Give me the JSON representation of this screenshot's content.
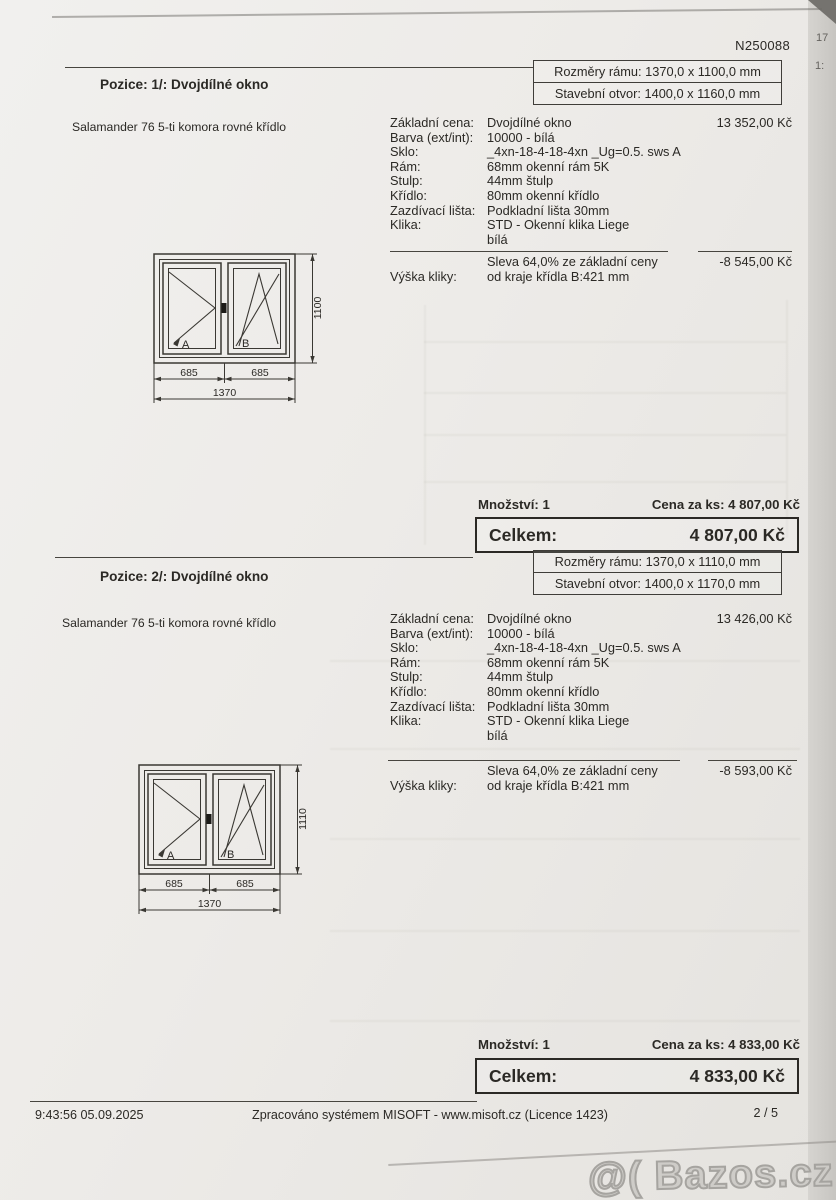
{
  "photo": {
    "watermark": "@( Bazos.cz",
    "edge_marks": [
      "17",
      "1:"
    ]
  },
  "document": {
    "number": "N250088",
    "footer": {
      "time": "9:43:56 05.09.2025",
      "center": "Zpracováno systémem MISOFT - www.misoft.cz (Licence 1423)",
      "page": "2 / 5"
    }
  },
  "positions": [
    {
      "title": "Pozice: 1/: Dvojdílné okno",
      "frame_size": "Rozměry rámu: 1370,0 x 1100,0 mm",
      "opening_size": "Stavební otvor: 1400,0 x 1160,0 mm",
      "product": "Salamander 76 5-ti komora rovné křídlo",
      "specs": [
        {
          "label": "Základní cena:",
          "value": "Dvojdílné okno",
          "price": "13 352,00 Kč"
        },
        {
          "label": "Barva (ext/int):",
          "value": "10000 - bílá"
        },
        {
          "label": "Sklo:",
          "value": "_4xn-18-4-18-4xn _Ug=0.5. sws A"
        },
        {
          "label": "Rám:",
          "value": "68mm okenní rám 5K"
        },
        {
          "label": "Stulp:",
          "value": "44mm štulp"
        },
        {
          "label": "Křídlo:",
          "value": "80mm okenní křídlo"
        },
        {
          "label": "Zazdívací lišta:",
          "value": "Podkladní lišta 30mm"
        },
        {
          "label": "Klika:",
          "value": "STD - Okenní klika Liege"
        },
        {
          "label": "",
          "value": "bílá"
        }
      ],
      "discount_label": "Sleva 64,0% ze základní ceny",
      "discount_price": "-8 545,00 Kč",
      "handle_label": "Výška kliky:",
      "handle_value": "od kraje křídla B:421 mm",
      "diagram": {
        "sash_a": "A",
        "sash_b": "B",
        "width_left": "685",
        "width_right": "685",
        "width_total": "1370",
        "height": "1100"
      },
      "quantity": "Množství: 1",
      "unit_price": "Cena za ks: 4 807,00 Kč",
      "total_label": "Celkem:",
      "total_price": "4 807,00 Kč"
    },
    {
      "title": "Pozice: 2/: Dvojdílné okno",
      "frame_size": "Rozměry rámu: 1370,0 x 1110,0 mm",
      "opening_size": "Stavební otvor: 1400,0 x 1170,0 mm",
      "product": "Salamander 76 5-ti komora rovné křídlo",
      "specs": [
        {
          "label": "Základní cena:",
          "value": "Dvojdílné okno",
          "price": "13 426,00 Kč"
        },
        {
          "label": "Barva (ext/int):",
          "value": "10000 - bílá"
        },
        {
          "label": "Sklo:",
          "value": "_4xn-18-4-18-4xn _Ug=0.5. sws A"
        },
        {
          "label": "Rám:",
          "value": "68mm okenní rám 5K"
        },
        {
          "label": "Stulp:",
          "value": "44mm štulp"
        },
        {
          "label": "Křídlo:",
          "value": "80mm okenní křídlo"
        },
        {
          "label": "Zazdívací lišta:",
          "value": "Podkladní lišta 30mm"
        },
        {
          "label": "Klika:",
          "value": "STD - Okenní klika Liege"
        },
        {
          "label": "",
          "value": "bílá"
        }
      ],
      "discount_label": "Sleva 64,0% ze základní ceny",
      "discount_price": "-8 593,00 Kč",
      "handle_label": "Výška kliky:",
      "handle_value": "od kraje křídla B:421 mm",
      "diagram": {
        "sash_a": "A",
        "sash_b": "B",
        "width_left": "685",
        "width_right": "685",
        "width_total": "1370",
        "height": "1110"
      },
      "quantity": "Množství: 1",
      "unit_price": "Cena za ks: 4 833,00 Kč",
      "total_label": "Celkem:",
      "total_price": "4 833,00 Kč"
    }
  ]
}
